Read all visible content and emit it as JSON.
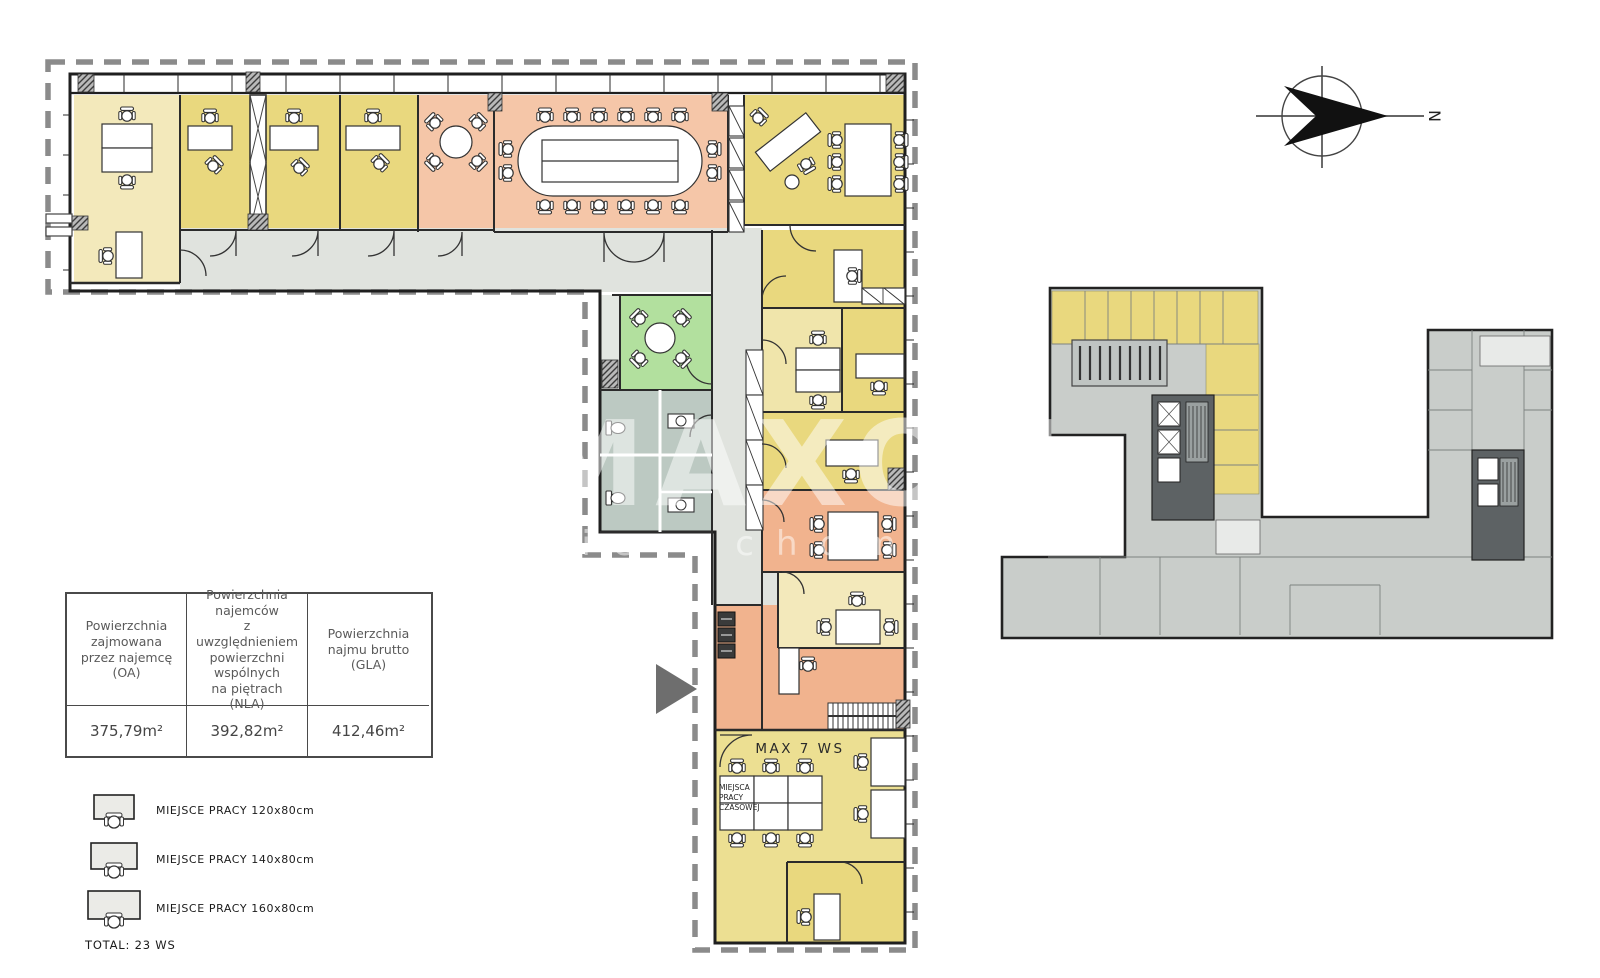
{
  "watermark": {
    "line1": "MAXON",
    "line2": "nieruchomości"
  },
  "compass": {
    "north_label": "N"
  },
  "main_plan": {
    "max_workstations_label": "MAX 7 WS",
    "temp_workplace_label": [
      "MIEJSCA",
      "PRACY",
      "CZASOWEJ"
    ]
  },
  "area_table": {
    "columns": [
      {
        "header": "Powierzchnia\nzajmowana\nprzez najemcę\n(OA)",
        "value": "375,79m²"
      },
      {
        "header": "Powierzchnia\nnajemców\nz uwzględnieniem\npowierzchni\nwspólnych\nna piętrach\n(NLA)",
        "value": "392,82m²"
      },
      {
        "header": "Powierzchnia\nnajmu brutto\n(GLA)",
        "value": "412,46m²"
      }
    ]
  },
  "legend": {
    "items": [
      {
        "label": "MIEJSCE PRACY 120x80cm",
        "icon": "desk-workstation-120"
      },
      {
        "label": "MIEJSCE PRACY 140x80cm",
        "icon": "desk-workstation-140"
      },
      {
        "label": "MIEJSCE PRACY 160x80cm",
        "icon": "desk-workstation-160"
      }
    ],
    "total": "TOTAL: 23 WS"
  },
  "colors": {
    "office_yellow": "#e9d87e",
    "office_pale_yellow": "#f0e5ab",
    "office_cream": "#f3e9bb",
    "meeting_peach": "#f5c6a8",
    "open_space_salmon": "#f1b38e",
    "kitchen_green": "#b2e09e",
    "corridor_gray": "#e0e3de",
    "sanitary_gray": "#bcc9c2",
    "overview_gray": "#c9cdca",
    "core_dark_gray": "#5d6264",
    "boundary_dash_gray": "#8b8b8b"
  }
}
